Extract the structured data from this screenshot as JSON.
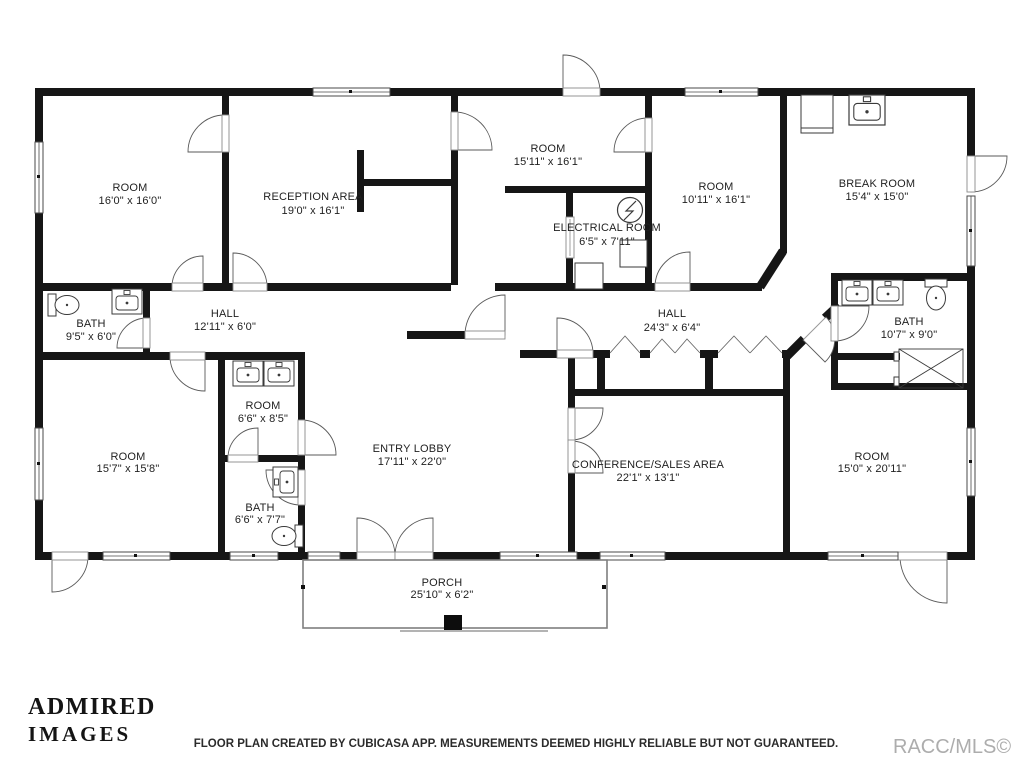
{
  "rooms": [
    {
      "name": "ROOM",
      "dims": "16'0\" x 16'0\""
    },
    {
      "name": "RECEPTION AREA",
      "dims": "19'0\" x 16'1\""
    },
    {
      "name": "ROOM",
      "dims": "15'11\" x 16'1\""
    },
    {
      "name": "ELECTRICAL ROOM",
      "dims": "6'5\" x 7'11\""
    },
    {
      "name": "ROOM",
      "dims": "10'11\" x 16'1\""
    },
    {
      "name": "BREAK ROOM",
      "dims": "15'4\" x 15'0\""
    },
    {
      "name": "BATH",
      "dims": "9'5\" x 6'0\""
    },
    {
      "name": "HALL",
      "dims": "12'11\" x 6'0\""
    },
    {
      "name": "HALL",
      "dims": "24'3\" x 6'4\""
    },
    {
      "name": "BATH",
      "dims": "10'7\" x 9'0\""
    },
    {
      "name": "ROOM",
      "dims": "15'7\" x 15'8\""
    },
    {
      "name": "ROOM",
      "dims": "6'6\" x 8'5\""
    },
    {
      "name": "ENTRY LOBBY",
      "dims": "17'11\" x 22'0\""
    },
    {
      "name": "CONFERENCE/SALES AREA",
      "dims": "22'1\" x 13'1\""
    },
    {
      "name": "BATH",
      "dims": "6'6\" x 7'7\""
    },
    {
      "name": "ROOM",
      "dims": "15'0\" x 20'11\""
    },
    {
      "name": "PORCH",
      "dims": "25'10\" x 6'2\""
    }
  ],
  "footer": {
    "disclaimer": "FLOOR PLAN CREATED BY CUBICASA APP. MEASUREMENTS DEEMED HIGHLY RELIABLE BUT NOT GUARANTEED.",
    "mls": "RACC/MLS©"
  },
  "logo": {
    "line1": "ADMIRED",
    "line2": "IMAGES"
  },
  "colors": {
    "wall": "#161616",
    "label": "#1f1f1f",
    "mls_gray": "#adadad"
  },
  "fixtures": [
    "sink",
    "toilet",
    "shower",
    "refrigerator",
    "electrical-panel"
  ]
}
